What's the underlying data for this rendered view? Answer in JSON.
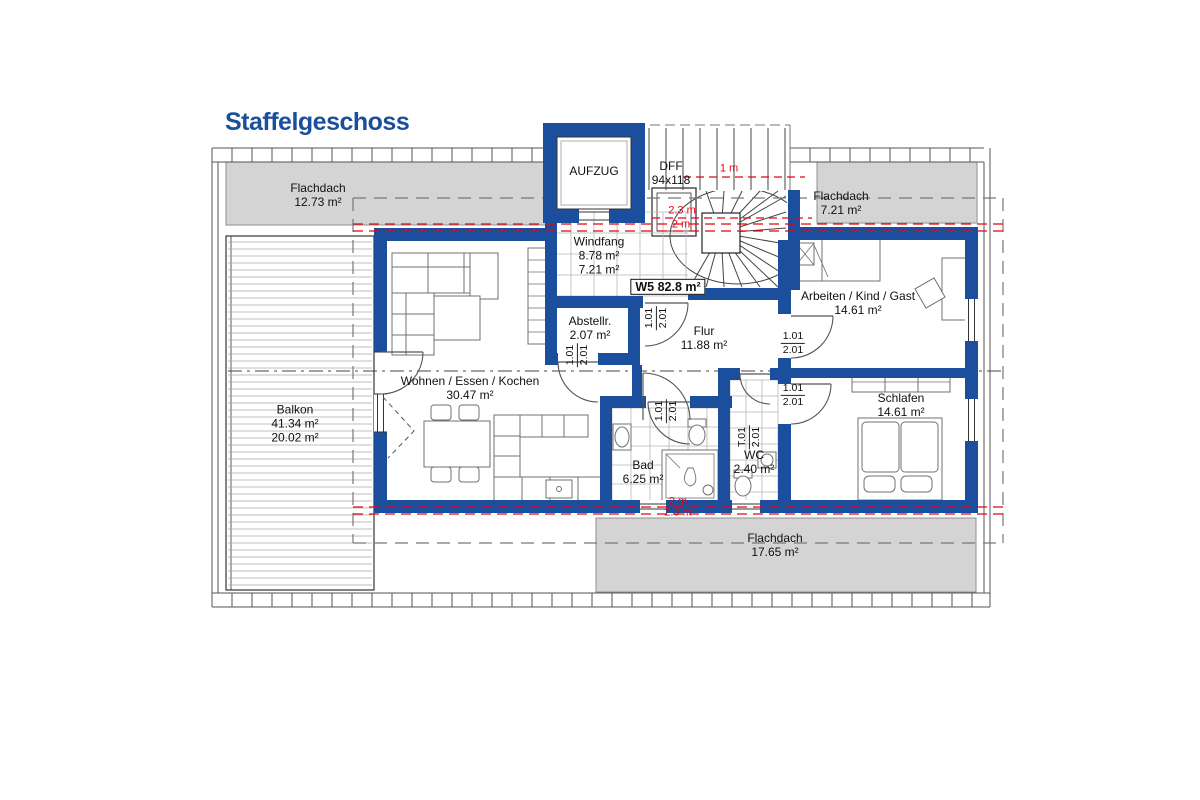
{
  "title": "Staffelgeschoss",
  "colors": {
    "wall_blue": "#1b4f9e",
    "dimension_red": "#e30613",
    "roof_gray": "#d4d4d4",
    "title_blue": "#1b4f9e"
  },
  "labels": {
    "flachdach_top_left": {
      "name": "Flachdach",
      "area": "12.73 m²"
    },
    "flachdach_top_right": {
      "name": "Flachdach",
      "area": "7.21 m²"
    },
    "flachdach_bottom": {
      "name": "Flachdach",
      "area": "17.65 m²"
    },
    "balkon": {
      "name": "Balkon",
      "area1": "41.34 m²",
      "area2": "20.02 m²"
    },
    "aufzug": "AUFZUG",
    "dff": {
      "name": "DFF",
      "size": "94x118"
    },
    "windfang": {
      "name": "Windfang",
      "area1": "8.78 m²",
      "area2": "7.21 m²"
    },
    "w5": "W5 82.8 m²",
    "abstellraum": {
      "name": "Abstellr.",
      "area": "2.07 m²"
    },
    "flur": {
      "name": "Flur",
      "area": "11.88 m²"
    },
    "wohnen": {
      "name": "Wohnen / Essen / Kochen",
      "area": "30.47 m²"
    },
    "bad": {
      "name": "Bad",
      "area": "6.25 m²"
    },
    "wc": {
      "name": "WC",
      "area": "2.40 m²"
    },
    "arbeiten": {
      "name": "Arbeiten / Kind / Gast",
      "area": "14.61 m²"
    },
    "schlafen": {
      "name": "Schlafen",
      "area": "14.61 m²"
    }
  },
  "red_dimensions": {
    "stair_top": "1 m",
    "stair_width_1": "2.3 m",
    "stair_width_2": "2 m",
    "bottom_width_1": "2 m",
    "bottom_width_2": "2.3 m"
  },
  "doors": [
    {
      "width": "1.01",
      "height": "2.01"
    },
    {
      "width": "1.01",
      "height": "2.01"
    },
    {
      "width": "1.01",
      "height": "2.01"
    },
    {
      "width": "T.01",
      "height": "2.01"
    },
    {
      "width": "1.01",
      "height": "2.01"
    },
    {
      "width": "1.01",
      "height": "2.01"
    }
  ]
}
